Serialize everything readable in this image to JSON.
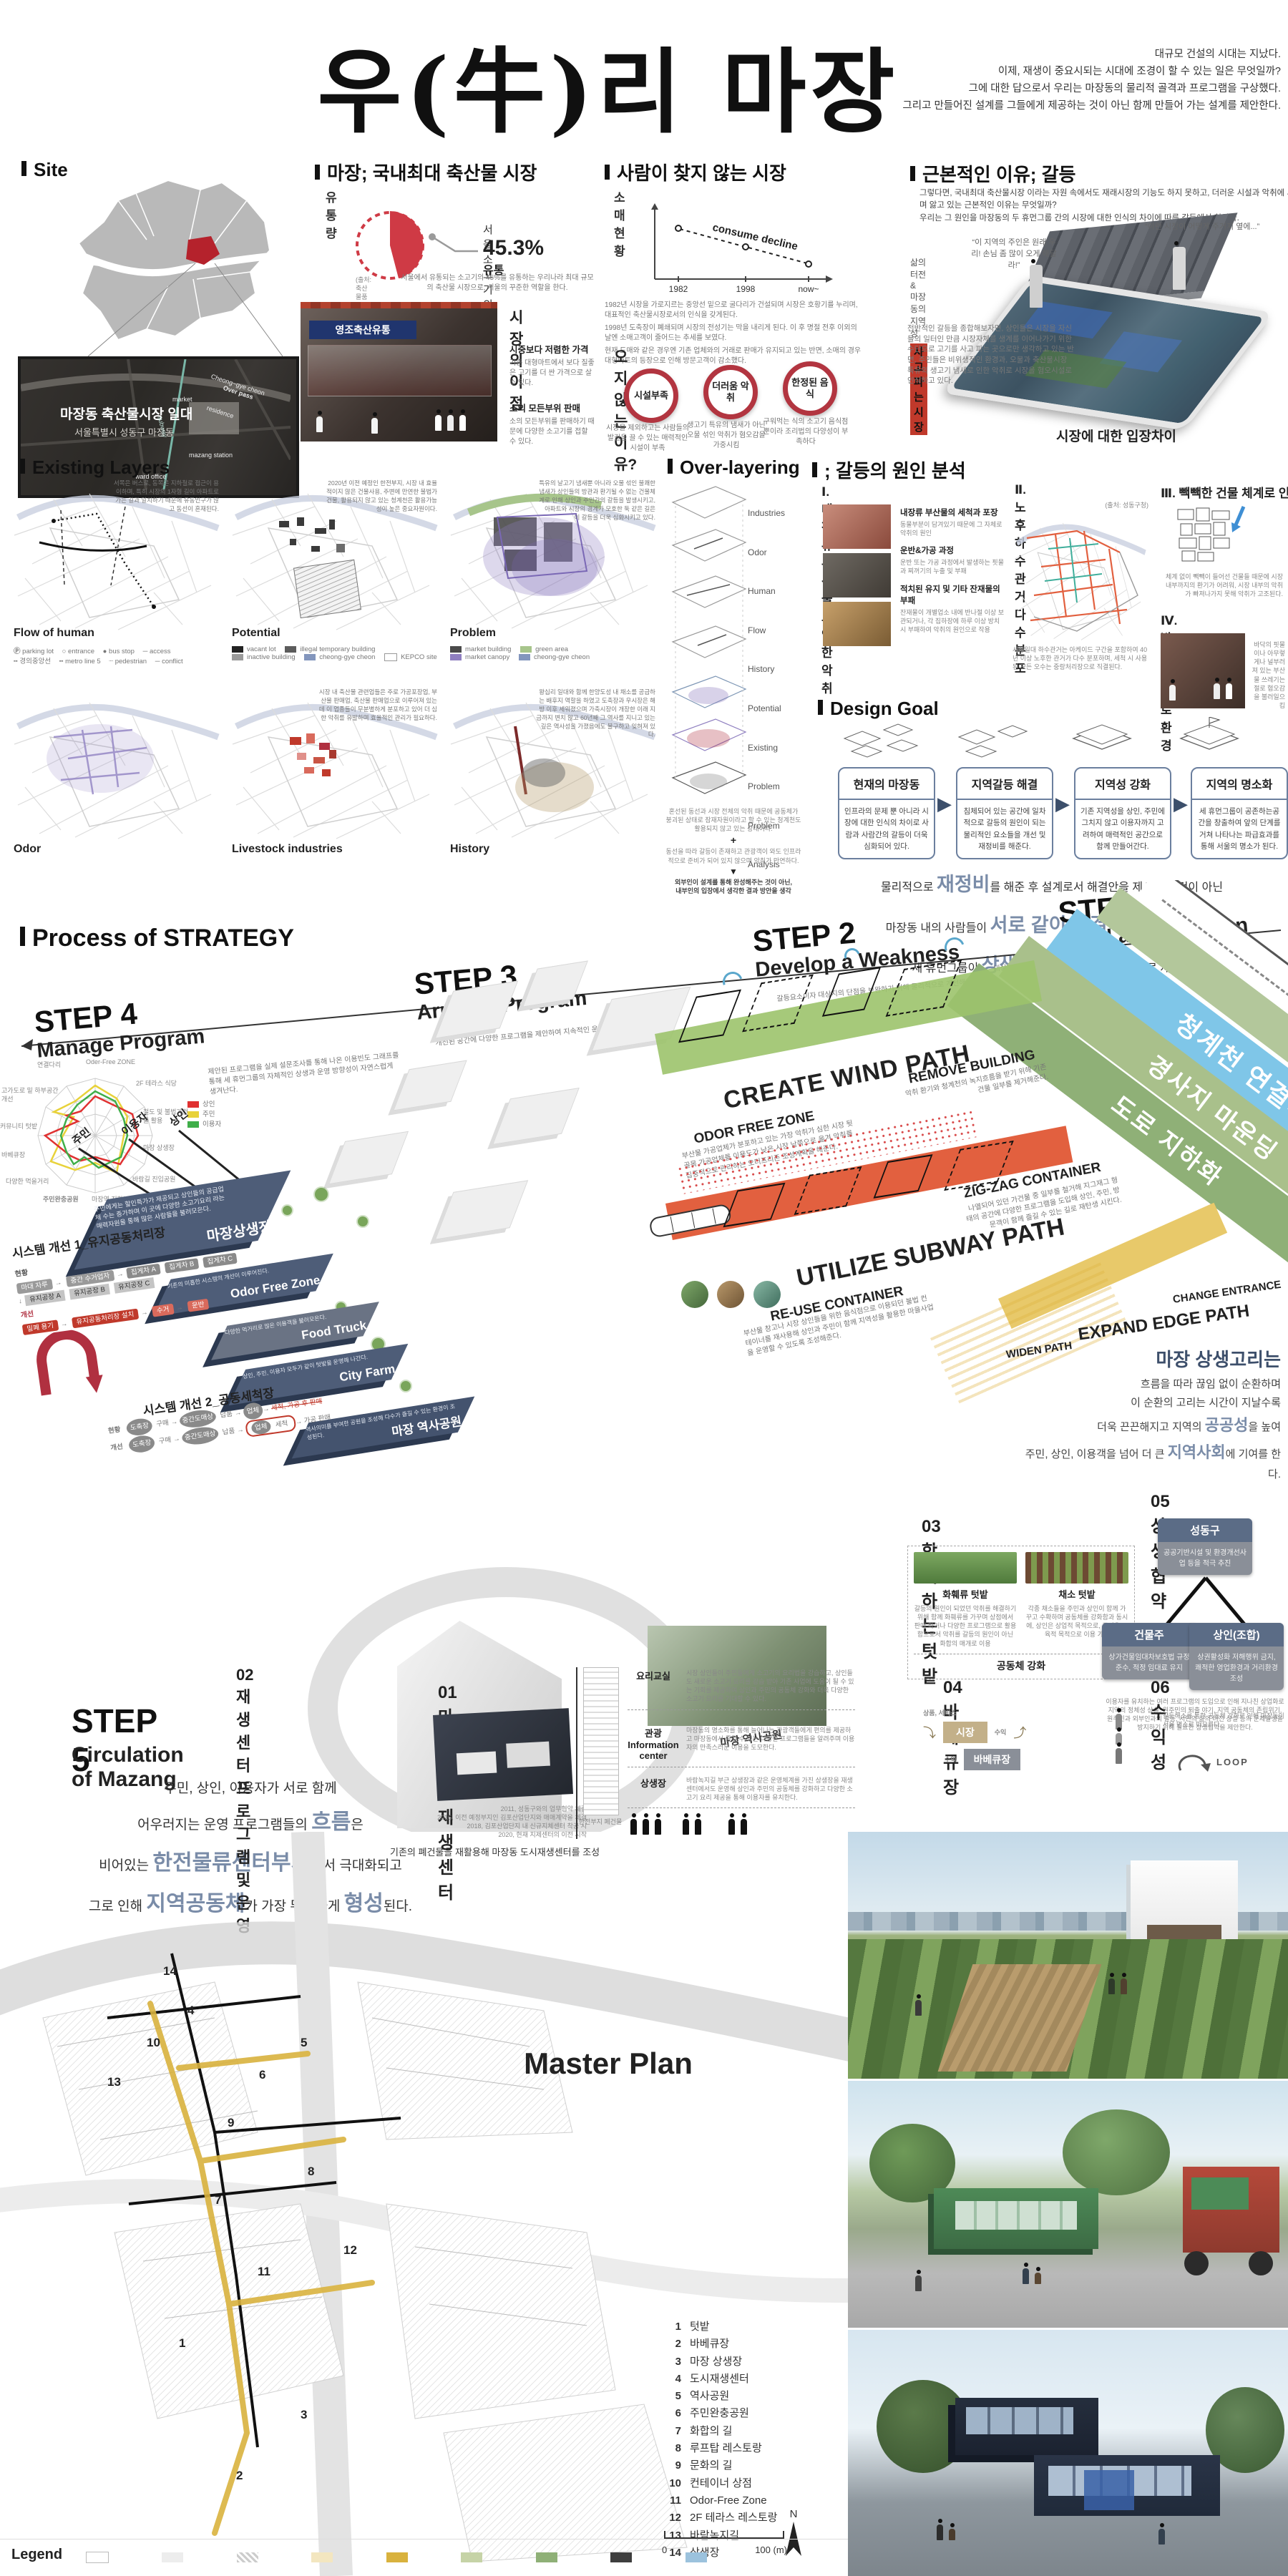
{
  "colors": {
    "accent_red": "#c0392b",
    "navy_plate": "#4e5d78",
    "band_blue": "#7fc6e8",
    "band_green": "#a9c08b",
    "band_green_dark": "#8fb077",
    "wind_green": "#9cc36b",
    "subway_orange": "#e2603f",
    "path_yellow": "#d9b23e",
    "radar_merchant": "#e03131",
    "radar_resident": "#f2d335",
    "radar_user": "#3fae49"
  },
  "header": {
    "title": "우(牛)리 마장",
    "intro": [
      "대규모 건설의 시대는 지났다.",
      "이제, 재생이 중요시되는 시대에 조경이 할 수 있는  일은 무엇일까?",
      "그에 대한 답으로서 우리는 마장동의 물리적 골격과 프로그램을 구상했다.",
      "그리고 만들어진 설계를 그들에게 제공하는 것이 아닌 함께 만들어 가는 설계를 제안한다."
    ]
  },
  "site": {
    "heading": "Site",
    "sat_title": "마장동 축산물시장 일대",
    "sat_sub": "서울특별시 성동구 마장동",
    "labels": {
      "cheonggye": "Cheong~gye cheon",
      "overpass": "Over pass",
      "market": "market",
      "subway": "subway",
      "residence": "residence",
      "station": "mazang station",
      "ward": "ward office"
    }
  },
  "market": {
    "heading": "마장; 국내최대 축산물 시장",
    "sub": "유통량",
    "callout_top": "서울 소고기의",
    "callout_pct": "45.3%",
    "callout_tail": "유통",
    "source": "(출처: 축산물품질평가원, 2015)",
    "desc": "서울에서 유통되는 소고기의 45%를 유통하는 우리나라 최대 규모의 축산물 시장으로, 서울의 꾸준한 역할을 한다.",
    "photo_sign": "영조축산유통",
    "adv_heading": "시장의 이점",
    "adv": [
      {
        "t": "시중보다 저렴한 가격",
        "d": "기존 대형마트에서 보다 질좋은 고기를 더 싼 가격으로 살 수 있다."
      },
      {
        "t": "소의 모든부위 판매",
        "d": "소의 모든부위를 판매하기 때문에 다양한 소고기를 접할 수 있다."
      }
    ]
  },
  "declining": {
    "heading": "사람이 찾지 않는 시장",
    "sub": "소매현황",
    "chart_data": {
      "type": "line",
      "title": "소매현황",
      "annotation": "consume decline",
      "x": [
        "1982",
        "1998",
        "now~"
      ],
      "values": [
        3,
        2,
        1
      ],
      "style": "dashed-decline"
    },
    "bullets": [
      "1982년 시장을 가로지르는 중앙선 밑으로 굴다리가 건설되며 시장은 호황기를 누리며, 대표적인 축산물시장로서의 인식을 갖게된다.",
      "1998년 도축장이 폐쇄되며 시장의 전성기는 막을 내리게 된다. 이 후 명절 전후 이외의 날엔 소매고객이 줄어드는 추세를 보였다.",
      "현재 도매와 같은 경우엔 기존 업체와의 거래로 판매가 유지되고 있는 반면, 소매의 경우 대형마트의 등장으로 인해 방문고객이 감소했다."
    ],
    "reasons_heading": "오지 않는 이유?",
    "reasons": [
      {
        "t": "시설부족",
        "d": "시장을 제외하고는 사람들의 발길을 끌 수 있는 매력적인 시설이 부족"
      },
      {
        "t": "더러움 악취",
        "d": "생고기 특유의 냄새가 아닌 오물 섞인 악취가 혐오감을 가중시킴"
      },
      {
        "t": "한정된 음식",
        "d": "구워먹는 식의 소고기 음식점 뿐이라 조리법의 다양성이 부족하다"
      }
    ]
  },
  "conflict": {
    "heading": "근본적인 이유; 갈등",
    "intro1": "그렇다면, 국내최대 축산물시장 이라는 자원 속에서도 재래시장의 기능도 하지 못하고, 더러운 시설과 악취에 시달리며 앓고 있는 근본적인 이유는 무엇일까?",
    "intro2": "우리는 그 원인을 마장동의 두 휴먼그룹 간의 시장에 대한 인식의 차이에 따른 갈등에서 찾았다.",
    "left_label1": "삶의 터전&",
    "left_label2": "마장동의 지역성",
    "left_highlight": "사고파는 시장",
    "left_quote": "“이 지역의 주인은 원래 우리! 손님 좀 많이 오게 해달라!”",
    "right_quote": "“이런 시장이 어떻게 주거지 옆에...”",
    "right_label1": "악취의 근원&",
    "right_label2": "혐오스러운 환경",
    "right_highlight": "혐오시설로 인식",
    "para_left": "전반적인 갈등을 종합해보자면, 상인들은 시장을 자신들의 일터인 만큼 시장자체를 생계를 이어나가기 위한 수단으로 고기를 사고 파는 곳으로만 생각하고 있는 반면, 주민들은 비위생적인 환경과, 오물과 축산물시장 특유의 생고기 냄새로 인한 악취로 시장을 혐오시설로 인식하고 있다.",
    "para_right": "인식의 차이에서 시작된 갈등은 상인들의 방관을 낳았고, 상인들은 도매와 판매에만 치중해서 자체적으로는 시장 내 활용 가능한 상가들이나, 거리환경 등에 신경을 전혀 쓰지 않고 방관하고 있으면서 “소매 고객만 많아졌으면~” 하는 태도를 보이고 있다.",
    "caption": "시장에 대한 입장차이"
  },
  "existing": {
    "heading": "Existing Layers",
    "panels": [
      {
        "label": "Flow of human",
        "note": "서쪽은 버스로, 동쪽은 지하철로 접근이 용이하며, 특히 시장의 1자형 길이 아파트로 가는 길과 일치하기 때문에 유동인구가 많고 동선이 혼재된다.",
        "legend": [
          "parking lot",
          "entrance",
          "bus stop",
          "access",
          "경의중앙선",
          "metro line 5",
          "pedestrian",
          "conflict"
        ]
      },
      {
        "label": "Potential",
        "note": "2020년 이전 예정인 한전부지, 시장 내 효율적이지 않은 건물사용, 주변에 만연한 불법가건물, 활용되지 않고 있는 청계천은 활용가능성이 높은 중요자원이다.",
        "legend": [
          "vacant lot",
          "illegal temporary building",
          "inactive building",
          "cheong-gye cheon",
          "KEPCO site"
        ]
      },
      {
        "label": "Problem",
        "note": "특유의 날고기 냄새뿐 아니라 오물 섞인 불쾌한 냄새가 상인들의 방관과 환기될 수 없는 건물체계로 인해 상인과 주민간의 갈등을 발생시키고, 아파트와 시장의 경계가 모호한 둑 같은 길은 이 갈등을 더욱 심화시키고 있다.",
        "legend": [
          "market building",
          "green area",
          "market canopy",
          "cheong-gye cheon"
        ]
      },
      {
        "label": "Odor",
        "note": "",
        "legend": []
      },
      {
        "label": "Livestock industries",
        "note": "시장 내 축산물 관련업들은 주로 가공포장업, 부산물 판매업, 축산물 판매업으로 이루어져 있는데 이 업종들이 무분별하게 분포하고 있어 더 심한 악취를 유발하며 효율적인 관리가 필요하다.",
        "legend": []
      },
      {
        "label": "History",
        "note": "왕십리 일대와 함께 한양도성 내 채소를 공급하는 배후지 역할을 하였고 도축장과 우시장은 해방 이후 세워졌으며 가축시장이 개장한 이래 지금까지 변치 않고 60년째 그 역사를 지니고 있는 깊은 역사성을 가졌음에도 불구하고 잊혀져 있다.",
        "legend": []
      }
    ]
  },
  "overlay": {
    "heading": "Over-layering",
    "layers": [
      "Industries",
      "Odor",
      "Human Flow",
      "History",
      "Potential",
      "Existing Problem",
      "Problem Analysis"
    ],
    "sum1": "혼선된 동선과 시장 전체의 악취 때문에 공동체가 붕괴된 상태로 잠재자원이라고 할 수 있는 청계천도 활용되지 않고 있는 상태이다.",
    "plus": "+",
    "sum2": "동선을 따라 갈등이 존재하고 관광객이 와도 인프라적으로 준비가 되어 있지 않으며 악취가 만연하다.",
    "concl1": "외부인이 설계를 통해 완성해주는 것이 아닌,",
    "concl2": "내부인의 입장에서 생각한 결과 방안을 생각"
  },
  "cause": {
    "heading": "; 갈등의 원인 분석",
    "i1": {
      "title": "Ⅰ. 내장류 부산물로 인한 악취",
      "points": [
        {
          "t": "내장류 부산물의 세척과 포장",
          "d": "동물부분이 담겨있기 때문에 그 자체로 악취의 원인"
        },
        {
          "t": "운반&가공 과정",
          "d": "운반 또는 가공 과정에서 발생하는 핏물과 찌꺼기의 누출 및 부패"
        },
        {
          "t": "적치된 유지 및 기타 잔재물의 부패",
          "d": "잔재물이 개별업소 내에 반나절 이상 보관되거나, 각 집하장에 하루 이상 방치시 부패하여 악취의 원인으로 작용"
        }
      ]
    },
    "i2": {
      "title": "Ⅱ. 노후 하수관거 다수 분포",
      "source": "(출처: 성동구청)",
      "caption": "시장일대 하수관거는 아케이드 구간을 포함하여 40년 이상 노후한 관거가 다수 분포하며, 세척 시 사용된 모든 오수는 중랑처리장으로 직결된다."
    },
    "i3": {
      "title": "Ⅲ. 빽빽한 건물 체계로 인한 환기 곤란",
      "caption": "체계 없이 빽빽이 들어선 건물들 때문에 시장 내부까지의 환기가 어려워, 시장 내부의 악취가 빠져나가지 못해 악취가 고조된다."
    },
    "i4": {
      "title": "Ⅳ. 방치된 가로환경",
      "caption": "바닥의 핏물이나 아무렇게나 널부러져 있는 부산물 쓰레기는 절로 혐오감을 불러일으킴"
    }
  },
  "goal": {
    "heading": "Design Goal",
    "boxes": [
      {
        "t": "현재의 마장동",
        "d": "인프라의 문제 뿐 아니라 시장에 대한 인식의 차이로 사람과 사람간의 갈등이 더욱 심화되어 있다."
      },
      {
        "t": "지역갈등 해결",
        "d": "침체되어 있는 공간에 일차적으로 갈등의 원인이 되는 물리적인 요소들을 개선 및 재정비를 해준다."
      },
      {
        "t": "지역성 강화",
        "d": "기존 지역성을 상인, 주민에 그치지 않고 이용자까지 고려하여 매력적인 공간으로 함께 만들어간다."
      },
      {
        "t": "지역의 명소화",
        "d": "세 휴먼그룹이 공존하는공간을 창출하여 앞의 단계를 거쳐 나타나는 파급효과를 통해 서울의 명소가 된다."
      }
    ],
    "s1a": "물리적으로 ",
    "s1b": "재정비",
    "s1c": "를 해준 후 설계로서 해결안을 제시하는 것이 아닌",
    "s2a": "마장동 내의 사람들이 ",
    "s2b": "서로 같이 해결해",
    "s2c": " 주민, 상인, 이용자,",
    "s3a": "세 휴먼그룹이 ",
    "s3b": "상생",
    "s3c": "하는 서울의 새로운 ",
    "s3d": "명소",
    "s3e": "로 재탄생"
  },
  "strategy": {
    "heading": "Process of STRATEGY",
    "steps": [
      {
        "num": "STEP 1",
        "name": "Build a Foundation",
        "note": "대상지의 기반을 마련한다."
      },
      {
        "num": "STEP 2",
        "name": "Develop a Weakness",
        "note": "갈등요소이자 대상지의 단점을 보완하기 위해 물리적으로 개선해준다."
      },
      {
        "num": "STEP 3",
        "name": "Arrange Program",
        "note": "개선된 공간에 다양한 프로그램을 제안하여 지속적인 운영을 도모한다."
      },
      {
        "num": "STEP 4",
        "name": "Manage Program",
        "note": "제안된 프로그램을 실제 설문조사를 통해 나온 이용빈도 그래프를 통해 세 휴먼그룹의 자체적인 상생과 운영 방향성이 자연스럽게 생겨난다."
      }
    ],
    "bands": [
      "청계천 연결다리",
      "경사지 마운딩",
      "도로 지하화"
    ],
    "wind": {
      "title": "CREATE WIND PATH",
      "s1": "REMOVE BUILDING",
      "s1d": "악취 환기와 청계천의 녹지흐름을 받기 위해 기존 건물 일부를 제거해준다.",
      "s2": "ODOR FREE ZONE",
      "s2d": "부산물 가공업체가 분포하고 있는 가장 악취가 심한 시장 뒷골목 가공업체를 이용도가 낮은 시장 남쪽으로 옮겨 악취를 집중적으로 관리하는 오더프리존 조성계획을 해준다."
    },
    "subway": {
      "title": "UTILIZE SUBWAY PATH",
      "s1": "RE-USE CONTAINER",
      "s1d": "부산물 창고나 시장 상인들을 위한 음식점으로 이용되던 불법 컨테이너를 재사용해 상인과 주민이 함께 지역성을 활용한 마을사업을 운영할 수 있도록 조성해준다.",
      "s2": "ZIG-ZAG CONTAINER",
      "s2d": "나열되어 있던 가건물 중 일부를 철거해 지그재그 형태의 공간에 다양한 프로그램을 도입해 상인, 주민, 방문객이 함께 즐길 수 있는 길로 재탄생 시킨다."
    },
    "edge": {
      "title": "EXPAND EDGE PATH",
      "s1": "WIDEN PATH",
      "s2": "CHANGE ENTRANCE"
    },
    "loop": {
      "title": "마장 상생고리는",
      "l1": "흐름을 따라 끊임 없이 순환하며",
      "l2": "이 순환의 고리는 시간이 지날수록",
      "l3a": "더욱 끈끈해지고 지역의 ",
      "l3b": "공공성",
      "l3c": "을 높여",
      "l4a": "주민, 상인, 이용객을 넘어 더 큰 ",
      "l4b": "지역사회",
      "l4c": "에 기여를 한다."
    }
  },
  "step4": {
    "radar_axes": [
      "Oder-Free ZONE",
      "2F 테라스 식당",
      "철도 및 불법가건물 활용",
      "마장 상생장",
      "바람길 진입공원",
      "마장역 지하보도",
      "주민완충공원",
      "다양한 먹을거리",
      "바베큐장",
      "커뮤니티 텃밭",
      "고가도로 밑 하부공간 개선",
      "연결다리"
    ],
    "legend": [
      {
        "t": "상인"
      },
      {
        "t": "주민"
      },
      {
        "t": "이용자"
      }
    ],
    "groups": [
      "주민",
      "이용자",
      "상인"
    ],
    "plates": [
      {
        "name": "마장상생장",
        "desc": "주민에게는 할인특가가 제공되고 상인들의 공급업체 수는 증가하며 이 곳에 다양한 소고기요리 라는 매력자원을 통해 많은 사람들을 불러모은다."
      },
      {
        "name": "Odor Free Zone",
        "desc": "기존의 미흡한 시스템의 개선이 이루어진다."
      },
      {
        "name": "Food Truck",
        "desc": "다양한 먹거리로 많은 이용객을 불러모은다."
      },
      {
        "name": "City Farm",
        "desc": "상인, 주민, 이용자 모두가 같이 텃밭을 운영해 나간다."
      },
      {
        "name": "마장 역사공원",
        "desc": "역사의미를 부여한 공원을 조성해 다수가 즐길 수 있는 환경이 조성된다."
      }
    ],
    "sys1": {
      "title": "시스템 개선 1_유지공동처리장",
      "now": "현황",
      "imp": "개선",
      "n1": "마대 자루",
      "n2": "중간 수거업자",
      "n3": "집게차 A",
      "n4": "집게차 B",
      "n5": "집게차 C",
      "f1": "유지공장 A",
      "f2": "유지공장 B",
      "f3": "유지공장 C",
      "i1": "밀폐 용기",
      "i2": "유지공동처리장 설치",
      "i3": "수거",
      "i4": "운반"
    },
    "sys2": {
      "title": "시스템 개선 2_공동세척장",
      "now": "현황",
      "imp": "개선",
      "n1": "도축장",
      "e1": "구매",
      "n2": "중간도매상",
      "e2": "납품",
      "n3": "업체",
      "strike": "세척, 가공 후 판매",
      "n4": "세척",
      "n5": "가공 판매"
    }
  },
  "step5": {
    "num": "STEP 5",
    "name": "Circulation of Mazang",
    "l1": "주민, 상인, 이용자가 서로 함께",
    "l2a": "어우러지는 운영 프로그램들의 ",
    "l2b": "흐름",
    "l2c": "은",
    "l3a": "비어있는 ",
    "l3b": "한전물류센터부지",
    "l3c": "에서 극대화되고",
    "l4a": "그로 인해 ",
    "l4b": "지역공동체",
    "l4c": "가 가장 뚜렷하게 ",
    "l4d": "형성",
    "l4e": "된다."
  },
  "programs": {
    "p01": {
      "heading": "01 마장 도심재생센터",
      "timeline": [
        "2011, 성동구와의 업무협약 체결",
        "2016, 이전 예정부지인 김포산업단지와 매매계약을 체결",
        "2018, 김포산업단지 내 신규지체센터 착공 시",
        "2020, 현재 지제센터의 이전 시작"
      ],
      "caption": "기존의 폐건물을 재활용해 마장동 도시재생센터를 조성",
      "building_label": "한전부지 폐건물",
      "rows": [
        {
          "t": "요리교실",
          "d": "시장 상인들이 주민들에게 소고기의 요리법을 강습하고, 상인들도 새로운 소고기 요리를 강습 받아 기존 사업에 도움이 될 수 있는 기회를 제공하여 상인과 주민의 공동체 강화와 더욱 다양한 소고기 요리를 기대할 수 있다."
        },
        {
          "t": "관광 Information center",
          "d": "마장동의 명소화를 통해 늘어나는 관광객들에게 편의를 제공하고 마장동에서 즐길 수 있는 다양한 프로그램들을 알려주며 이용자의 만족스러운 이용을 도모한다."
        },
        {
          "t": "상생장",
          "d": "바람녹지길 부근 상생장과 같은 운영체계를 가진 상생장을 재생센터에서도 운영해 상인과 주민의 공동체를 강화하고 다양한 소고기 요리 제공을 통해 이용자를 유치한다."
        }
      ]
    },
    "p02": {
      "heading": "02 재생센터 프로그램 및 운영"
    },
    "p03": {
      "heading": "03 함께하는 텃밭",
      "cards": [
        {
          "t": "화훼류 텃밭",
          "d": "갈등의 원인이 되었던 악취를 해결하기 위해 함께 화훼류를 가꾸며 상점에서 판매 하거나 다양한 프로그램으로 활용함으로서 악취를 갈등의 원인이 아닌 화합의 매개로 이용"
        },
        {
          "t": "채소 텃밭",
          "d": "각종 채소들을 주민과 상인이 함께 가꾸고 수확하며 공동체를 강화함과 동시에, 상인은 상업적 목적으로, 주민은 교육적 목적으로 이용 가능"
        }
      ],
      "footer": "공동체 강화"
    },
    "p04": {
      "heading": "04 바베큐장",
      "b1": "시장",
      "b2": "바베큐장",
      "l1": "상품, 서비스",
      "l2": "수익",
      "l3": "수익"
    },
    "p05": {
      "heading": "05 상생협약",
      "nodes": [
        {
          "t": "성동구",
          "d": "공공기반시설 및 환경개선사업 등을 적극 추진"
        },
        {
          "t": "건물주",
          "d": "상가건물임대차보호법 규정 준수, 적정 임대료 유지"
        },
        {
          "t": "상인(조합)",
          "d": "상권활성화 저해행위 금지, 쾌적한 영업환경과 거리환경 조성"
        }
      ],
      "para": "이용자를 유치하는 여러 프로그램의 도입으로 인해 지나친 상업화로 지역의 정체성 상실, 원주민의 퇴출 야기, 지역 공동체의 존립위기, 원주민과 외부인과의 갈등, 서민의 삶의 터전 상실 등의 문제발생을 방지하기 위해 필요한 상생협약을 제안한다."
    },
    "p06": {
      "heading": "06 수익성",
      "d": "갈등해소를 통한 공동체 강화로 인해 마장동이 서울 명소로 떠오른다.",
      "loop_label": "LOOP"
    }
  },
  "master": {
    "heading": "Master Plan",
    "list": [
      {
        "n": "1",
        "t": "텃밭"
      },
      {
        "n": "2",
        "t": "바베큐장"
      },
      {
        "n": "3",
        "t": "마장 상생장"
      },
      {
        "n": "4",
        "t": "도시재생센터"
      },
      {
        "n": "5",
        "t": "역사공원"
      },
      {
        "n": "6",
        "t": "주민완충공원"
      },
      {
        "n": "7",
        "t": "화합의 길"
      },
      {
        "n": "8",
        "t": "루프탑 레스토랑"
      },
      {
        "n": "9",
        "t": "문화의 길"
      },
      {
        "n": "10",
        "t": "컨테이너 상점"
      },
      {
        "n": "11",
        "t": "Odor-Free Zone"
      },
      {
        "n": "12",
        "t": "2F 테라스 레스토랑"
      },
      {
        "n": "13",
        "t": "바람녹지길"
      },
      {
        "n": "14",
        "t": "상생장"
      }
    ],
    "scale0": "0",
    "scale100": "100 (m)",
    "north": "N",
    "legend_title": "Legend"
  }
}
